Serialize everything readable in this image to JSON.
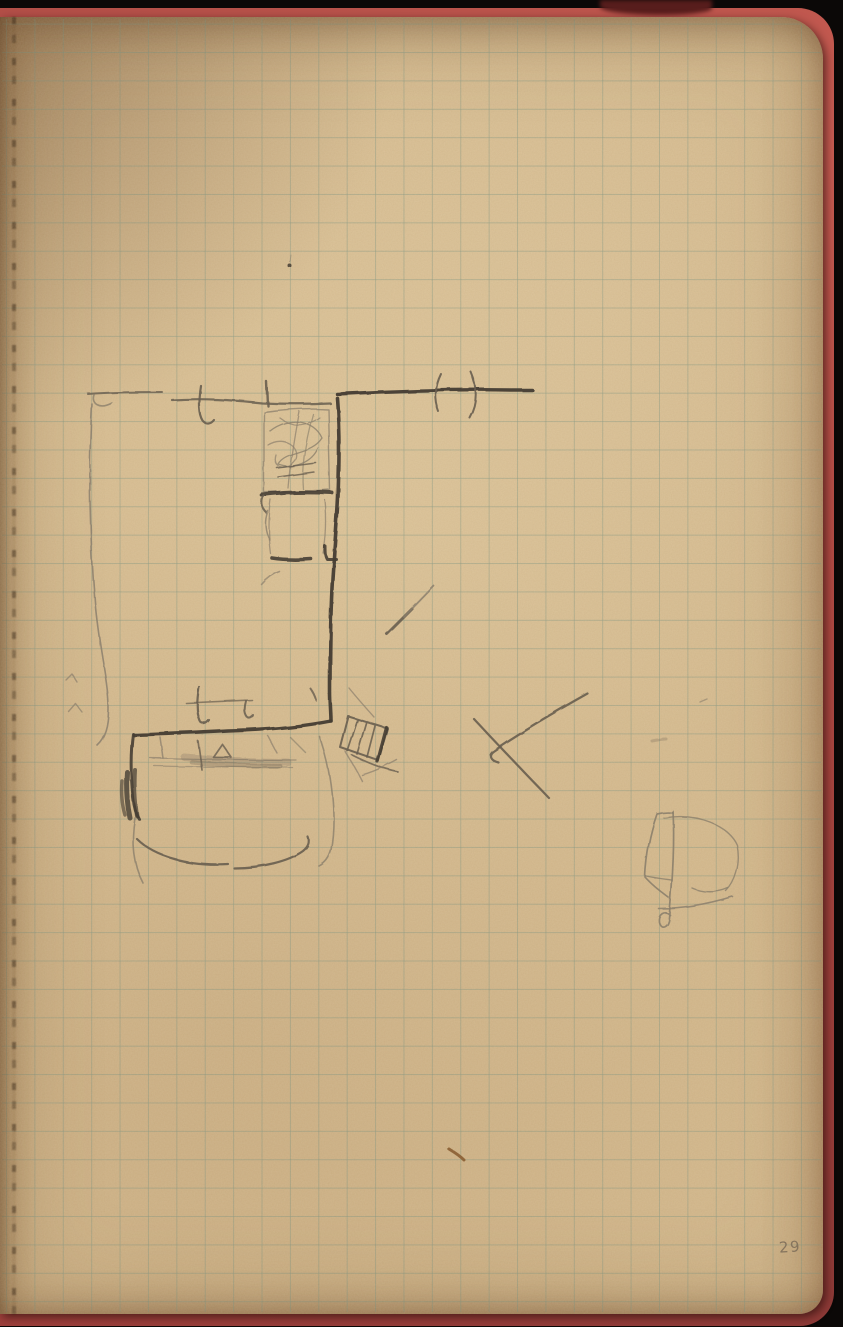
{
  "page": {
    "number": "29"
  },
  "colors": {
    "background": "#0b0807",
    "cover_red": "#b24e47",
    "paper": "#d4b88b",
    "grid_line": "#6c8c7c",
    "pencil_dark": "#453d33",
    "pencil_medium": "#685e50",
    "pencil_faint": "#8b7f6c",
    "fleck_brown": "#865b2f",
    "page_number_gray": "#7f6f5a"
  },
  "sketch": {
    "strokes": [
      {
        "name": "wall-top-left-segment",
        "d": "M88,394 C112,392 138,392 162,392",
        "w": 2,
        "c": "pencil_medium",
        "o": 0.8
      },
      {
        "name": "wall-top-left-hook",
        "d": "M94,395 C91,403 99,410 112,403",
        "w": 1.6,
        "c": "pencil_faint",
        "o": 0.8
      },
      {
        "name": "wall-top-mid-segment",
        "d": "M172,400 C203,398 232,400 262,403 C285,404 308,404 330,403",
        "w": 2.2,
        "c": "pencil_medium",
        "o": 0.85
      },
      {
        "name": "door-tick-top-1",
        "d": "M201,386 C199,399 198,413 203,421 C206,425 211,424 214,420",
        "w": 2.2,
        "c": "pencil_medium",
        "o": 0.9
      },
      {
        "name": "door-tick-top-2",
        "d": "M267,382 L268,406",
        "w": 2.4,
        "c": "pencil_medium",
        "o": 0.9
      },
      {
        "name": "wall-top-right-bold",
        "d": "M337,394 C395,391 460,389 510,390 L532,390",
        "w": 3.4,
        "c": "pencil_dark",
        "o": 0.95
      },
      {
        "name": "door-swing-paren-left",
        "d": "M441,374 C435,386 434,399 439,412",
        "w": 2,
        "c": "pencil_medium",
        "o": 0.9
      },
      {
        "name": "door-swing-paren-right",
        "d": "M471,372 C478,388 478,404 470,418",
        "w": 2,
        "c": "pencil_medium",
        "o": 0.9
      },
      {
        "name": "wall-vertical-bold",
        "d": "M337,398 C340,435 339,468 338,497 C337,520 335,540 334,558 C331,592 330,648 330,692 C330,704 331,713 331,721",
        "w": 3.6,
        "c": "pencil_dark",
        "o": 0.95
      },
      {
        "name": "wall-bottom-horizontal",
        "d": "M331,721 C300,727 264,730 228,731 C196,733 160,734 134,735",
        "w": 3.4,
        "c": "pencil_dark",
        "o": 0.95
      },
      {
        "name": "wall-left-vertical",
        "d": "M133,734 C130,756 131,778 133,797 C134,808 136,814 139,819",
        "w": 3,
        "c": "pencil_dark",
        "o": 0.9
      },
      {
        "name": "wall-left-dark-blob-1",
        "d": "M127,772 C126,788 127,804 130,818",
        "w": 5,
        "c": "pencil_dark",
        "o": 0.8
      },
      {
        "name": "wall-left-dark-blob-2",
        "d": "M135,770 C134,786 135,802 137,816",
        "w": 4,
        "c": "pencil_dark",
        "o": 0.7
      },
      {
        "name": "wall-left-dark-blob-3",
        "d": "M122,781 C121,793 122,805 125,815",
        "w": 3.5,
        "c": "pencil_dark",
        "o": 0.6
      },
      {
        "name": "cabinet-outline",
        "d": "M264,412 C286,409 308,408 328,409 L330,490 C308,492 285,493 264,492 Z",
        "w": 1.4,
        "c": "pencil_faint",
        "o": 0.75
      },
      {
        "name": "cabinet-scribble-1",
        "d": "M270,431 C289,416 314,420 322,438 C311,455 286,450 278,464 C294,470 312,462 318,448",
        "w": 1.3,
        "c": "pencil_faint",
        "o": 0.8
      },
      {
        "name": "cabinet-scribble-2",
        "d": "M268,445 C284,435 301,447 295,460 C286,472 272,468 276,455",
        "w": 1.3,
        "c": "pencil_faint",
        "o": 0.7
      },
      {
        "name": "cabinet-scribble-3",
        "d": "M280,418 C294,429 308,425 319,417",
        "w": 1.3,
        "c": "pencil_faint",
        "o": 0.7
      },
      {
        "name": "cabinet-scribble-4",
        "d": "M299,411 C294,438 290,464 288,488",
        "w": 1.3,
        "c": "pencil_faint",
        "o": 0.7
      },
      {
        "name": "cabinet-scribble-5",
        "d": "M313,414 C306,440 301,468 303,489",
        "w": 1.3,
        "c": "pencil_faint",
        "o": 0.65
      },
      {
        "name": "cabinet-hatch-1",
        "d": "M277,468 L316,463",
        "w": 1.6,
        "c": "pencil_medium",
        "o": 0.8
      },
      {
        "name": "cabinet-hatch-2",
        "d": "M278,477 L314,472",
        "w": 1.6,
        "c": "pencil_medium",
        "o": 0.8
      },
      {
        "name": "shelf-line-bold",
        "d": "M262,495 C286,492 310,492 332,493",
        "w": 4,
        "c": "pencil_dark",
        "o": 0.9
      },
      {
        "name": "shelf-hook",
        "d": "M264,496 C261,502 262,509 267,513",
        "w": 2.2,
        "c": "pencil_medium",
        "o": 0.85
      },
      {
        "name": "lower-cabinet-left",
        "d": "M271,500 C268,520 269,540 271,554",
        "w": 1.3,
        "c": "pencil_faint",
        "o": 0.7
      },
      {
        "name": "lower-cabinet-right",
        "d": "M325,500 C327,520 326,540 323,553",
        "w": 1.3,
        "c": "pencil_faint",
        "o": 0.7
      },
      {
        "name": "lower-cabinet-curve",
        "d": "M268,511 C264,521 265,532 270,540",
        "w": 1.5,
        "c": "pencil_faint",
        "o": 0.8
      },
      {
        "name": "shelf2-bold",
        "d": "M272,558 C285,560 298,560 311,559",
        "w": 3.6,
        "c": "pencil_dark",
        "o": 0.9
      },
      {
        "name": "wall-notch",
        "d": "M325,546 C325,552 325,556 327,559 L336,559",
        "w": 3,
        "c": "pencil_dark",
        "o": 0.9
      },
      {
        "name": "faint-tick-mid",
        "d": "M262,585 C268,578 274,574 280,572",
        "w": 1.5,
        "c": "pencil_faint",
        "o": 0.7
      },
      {
        "name": "diagonal-stroke-thick",
        "d": "M387,634 L412,609",
        "w": 3,
        "c": "pencil_medium",
        "o": 0.9
      },
      {
        "name": "diagonal-stroke-thin",
        "d": "M404,617 L434,586",
        "w": 1.8,
        "c": "pencil_faint",
        "o": 0.85
      },
      {
        "name": "wall-tick-small",
        "d": "M310,688 C313,692 315,696 316,700",
        "w": 2,
        "c": "pencil_medium",
        "o": 0.8
      },
      {
        "name": "door-tick-lower-hook",
        "d": "M199,687 C197,700 196,712 200,721 C202,725 206,724 209,720",
        "w": 2.2,
        "c": "pencil_medium",
        "o": 0.9
      },
      {
        "name": "door-tick-lower-connector",
        "d": "M186,703 L252,700",
        "w": 1.6,
        "c": "pencil_medium",
        "o": 0.7
      },
      {
        "name": "door-tick-lower-2",
        "d": "M246,701 C244,708 244,713 247,717 C249,719 252,718 253,715",
        "w": 2,
        "c": "pencil_medium",
        "o": 0.85
      },
      {
        "name": "stove-outline",
        "d": "M348,716 L387,728 L378,760 L340,747 Z",
        "w": 2,
        "c": "pencil_medium",
        "o": 0.9
      },
      {
        "name": "stove-slat-1",
        "d": "M357,720 L347,751",
        "w": 1.7,
        "c": "pencil_medium",
        "o": 0.85
      },
      {
        "name": "stove-slat-2",
        "d": "M366,723 L357,754",
        "w": 1.7,
        "c": "pencil_medium",
        "o": 0.85
      },
      {
        "name": "stove-slat-3",
        "d": "M375,726 L367,757",
        "w": 1.7,
        "c": "pencil_medium",
        "o": 0.85
      },
      {
        "name": "stove-edge-bold",
        "d": "M386,727 L377,761",
        "w": 3.2,
        "c": "pencil_dark",
        "o": 0.9
      },
      {
        "name": "stove-mark-1",
        "d": "M352,755 C368,763 383,769 398,772",
        "w": 1.7,
        "c": "pencil_medium",
        "o": 0.8
      },
      {
        "name": "stove-mark-2",
        "d": "M362,775 C375,771 388,765 397,760",
        "w": 1.4,
        "c": "pencil_faint",
        "o": 0.7
      },
      {
        "name": "stove-mark-3",
        "d": "M345,751 C351,761 357,771 362,781",
        "w": 1.4,
        "c": "pencil_faint",
        "o": 0.7
      },
      {
        "name": "stove-diagonal-faint",
        "d": "M349,688 C357,698 366,708 374,717",
        "w": 1.4,
        "c": "pencil_faint",
        "o": 0.7
      },
      {
        "name": "x-mark-long",
        "d": "M588,694 C556,712 520,733 494,751 C488,755 490,760 498,762",
        "w": 2.2,
        "c": "pencil_medium",
        "o": 0.9
      },
      {
        "name": "x-mark-cross",
        "d": "M474,719 C498,745 524,772 549,798",
        "w": 2.2,
        "c": "pencil_medium",
        "o": 0.9
      },
      {
        "name": "left-wall-curve",
        "d": "M92,404 C88,470 90,542 95,602 C99,646 106,672 108,697 C110,721 106,737 97,745",
        "w": 1.6,
        "c": "pencil_faint",
        "o": 0.85
      },
      {
        "name": "check-mark-1",
        "d": "M66,680 L72,674 L77,682",
        "w": 1.4,
        "c": "pencil_faint",
        "o": 0.7
      },
      {
        "name": "check-mark-2",
        "d": "M68,711 L75,703 L82,712",
        "w": 1.4,
        "c": "pencil_faint",
        "o": 0.7
      },
      {
        "name": "bed-line-1",
        "d": "M150,758 C198,759 248,760 296,760",
        "w": 1.2,
        "c": "pencil_faint",
        "o": 0.7
      },
      {
        "name": "bed-line-2",
        "d": "M154,766 C200,767 246,767 292,767",
        "w": 1.2,
        "c": "pencil_faint",
        "o": 0.6
      },
      {
        "name": "bed-shading-1",
        "d": "M184,757 C218,760 254,762 288,762",
        "w": 7,
        "c": "pencil_medium",
        "o": 0.22
      },
      {
        "name": "bed-shading-2",
        "d": "M192,762 C220,765 252,766 280,766",
        "w": 5,
        "c": "pencil_medium",
        "o": 0.28
      },
      {
        "name": "bed-leg-1",
        "d": "M160,737 L163,758",
        "w": 1.5,
        "c": "pencil_faint",
        "o": 0.75
      },
      {
        "name": "bed-leg-2",
        "d": "M198,741 L202,770",
        "w": 1.7,
        "c": "pencil_medium",
        "o": 0.8
      },
      {
        "name": "bed-triangle",
        "d": "M213,757 L222,744 L231,757 Z",
        "w": 1.7,
        "c": "pencil_medium",
        "o": 0.8
      },
      {
        "name": "bed-diag-1",
        "d": "M268,736 L277,753",
        "w": 1.4,
        "c": "pencil_faint",
        "o": 0.7
      },
      {
        "name": "bed-diag-2",
        "d": "M290,737 L305,752",
        "w": 1.4,
        "c": "pencil_faint",
        "o": 0.65
      },
      {
        "name": "bed-arc-bottom-1",
        "d": "M137,839 C156,858 191,866 228,864",
        "w": 2.2,
        "c": "pencil_medium",
        "o": 0.9
      },
      {
        "name": "bed-arc-bottom-2",
        "d": "M234,868 C262,868 289,861 303,851 C308,847 310,842 308,837",
        "w": 2.2,
        "c": "pencil_medium",
        "o": 0.9
      },
      {
        "name": "bed-left-curve",
        "d": "M135,818 C131,841 133,864 143,883",
        "w": 1.6,
        "c": "pencil_faint",
        "o": 0.8
      },
      {
        "name": "bed-right-arc",
        "d": "M320,737 C332,772 337,816 331,850 C329,858 325,863 319,866",
        "w": 1.6,
        "c": "pencil_faint",
        "o": 0.8
      },
      {
        "name": "flag-pole",
        "d": "M673,811 C675,847 672,887 669,918 C668,927 661,930 659,922 C658,914 665,910 670,915",
        "w": 1.7,
        "c": "pencil_faint",
        "o": 0.9
      },
      {
        "name": "flag-body",
        "d": "M673,813 C667,812 661,813 657,814 C650,834 646,856 645,877 C652,885 661,892 669,898",
        "w": 1.7,
        "c": "pencil_faint",
        "o": 0.9
      },
      {
        "name": "flag-mid-line",
        "d": "M646,876 C655,878 664,879 672,880",
        "w": 1.4,
        "c": "pencil_faint",
        "o": 0.8
      },
      {
        "name": "flag-arc",
        "d": "M664,818 C698,812 729,826 737,845 C741,864 735,882 726,891",
        "w": 1.4,
        "c": "pencil_faint",
        "o": 0.8
      },
      {
        "name": "flag-curve-small",
        "d": "M692,888 C703,893 717,893 728,888",
        "w": 1.4,
        "c": "pencil_faint",
        "o": 0.8
      },
      {
        "name": "flag-swoosh",
        "d": "M659,909 C683,909 710,904 733,897",
        "w": 1.6,
        "c": "pencil_faint",
        "o": 0.85
      },
      {
        "name": "smudge-mark",
        "d": "M652,741 C657,740 662,739 666,739",
        "w": 3,
        "c": "pencil_medium",
        "o": 0.25
      },
      {
        "name": "tiny-mark-right",
        "d": "M700,702 L707,699",
        "w": 1.4,
        "c": "pencil_faint",
        "o": 0.6
      },
      {
        "name": "ink-dot",
        "d": "M288,266 a2,2 0 1 0 4,0 a2,2 0 1 0 -4,0",
        "w": 1,
        "c": "pencil_dark",
        "o": 0.85,
        "fill": true
      },
      {
        "name": "fleck-hair",
        "d": "M291,255 L290,262",
        "w": 1,
        "c": "pencil_faint",
        "o": 0.5
      },
      {
        "name": "brown-fleck",
        "d": "M449,1149 C454,1152 460,1156 464,1160",
        "w": 3,
        "c": "fleck_brown",
        "o": 0.85
      }
    ]
  }
}
